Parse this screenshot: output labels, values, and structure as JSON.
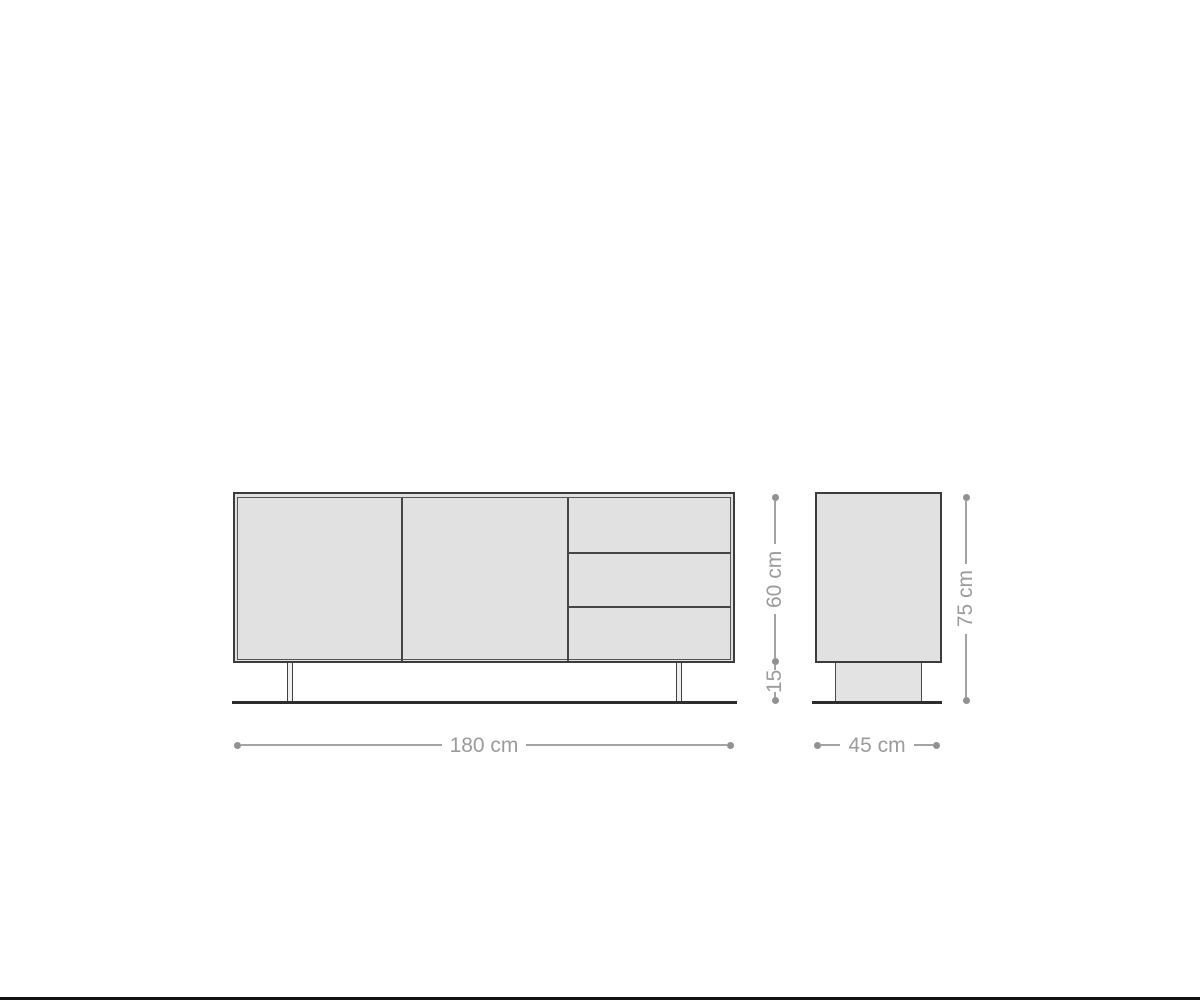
{
  "canvas": {
    "width": 1200,
    "height": 1000,
    "background": "#ffffff"
  },
  "colors": {
    "furniture_fill": "#e1e1e1",
    "furniture_outline": "#3c3c3c",
    "inner_panel_line": "#565656",
    "ground_line": "#2d2d2d",
    "dimension_line": "#a3a3a3",
    "dimension_dot": "#919191",
    "dimension_text": "#9b9b9b",
    "bottom_edge_bar": "#121212"
  },
  "diagram": {
    "type": "furniture-dimension-drawing",
    "subject": "sideboard",
    "front_view": {
      "doors": 2,
      "drawers": 3,
      "legs": 2
    },
    "side_view": {
      "has_plinth_base": true
    }
  },
  "labels": {
    "width": "180 cm",
    "depth": "45 cm",
    "body_height": "60 cm",
    "leg_height": "15",
    "total_height": "75 cm"
  }
}
